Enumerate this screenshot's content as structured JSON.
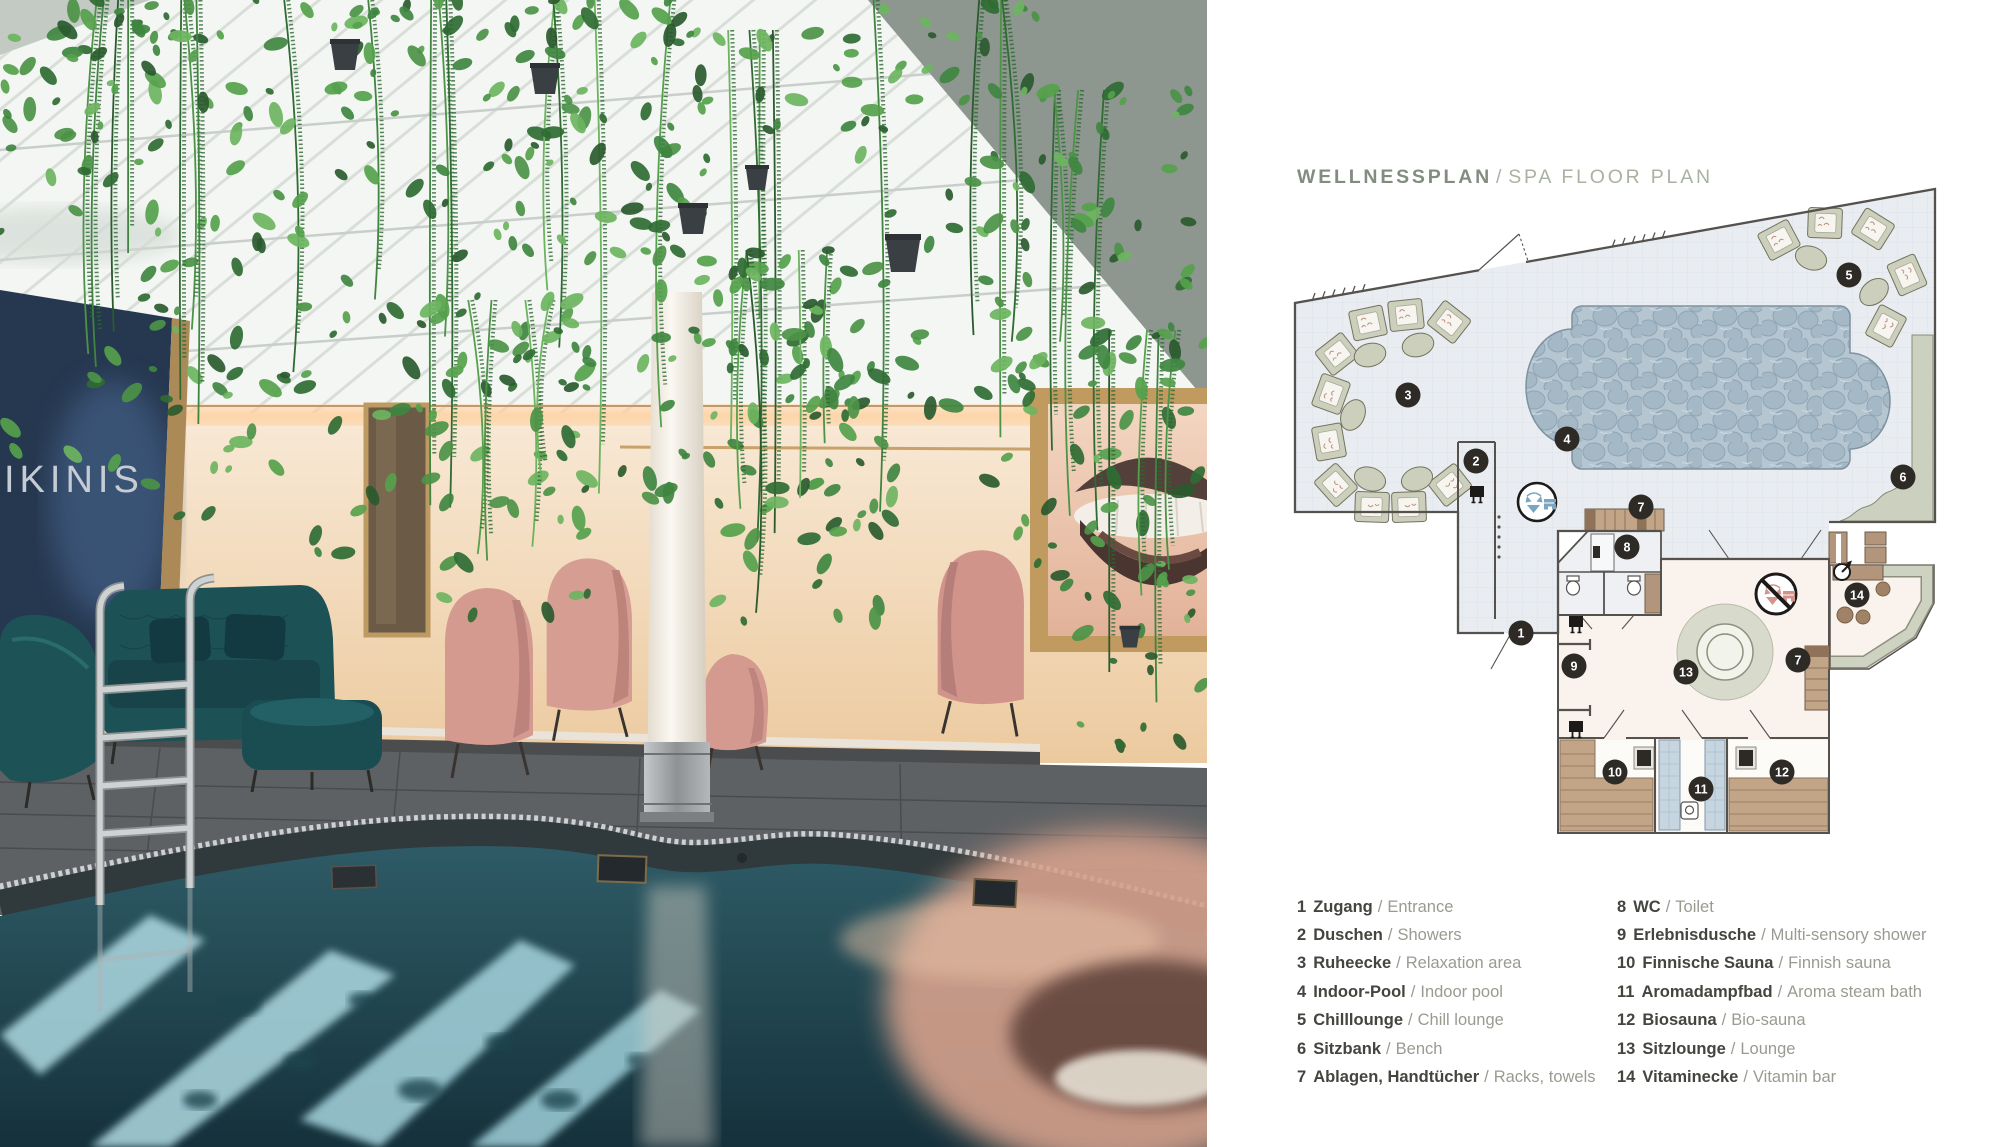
{
  "title": {
    "de": "WELLNESSPLAN",
    "separator": "/",
    "en": "SPA FLOOR PLAN"
  },
  "photo": {
    "wall_text": "IKINIS",
    "description": "indoor spa pool with hanging plants, pink lounge chairs, teal sofa, lips artwork",
    "plants": [
      {
        "x": 0,
        "y": 0,
        "w": 210,
        "h": 470
      },
      {
        "x": 150,
        "y": 0,
        "w": 200,
        "h": 560
      },
      {
        "x": 330,
        "y": 0,
        "w": 210,
        "h": 520
      },
      {
        "x": 520,
        "y": 0,
        "w": 190,
        "h": 500
      },
      {
        "x": 640,
        "y": 30,
        "w": 220,
        "h": 560
      },
      {
        "x": 830,
        "y": 0,
        "w": 210,
        "h": 540
      },
      {
        "x": 990,
        "y": 90,
        "w": 200,
        "h": 500
      },
      {
        "x": 1080,
        "y": 330,
        "w": 125,
        "h": 420
      },
      {
        "x": 430,
        "y": 300,
        "w": 160,
        "h": 330
      },
      {
        "x": 700,
        "y": 250,
        "w": 180,
        "h": 380
      }
    ]
  },
  "legend_left": [
    {
      "num": "1",
      "de": "Zugang",
      "en": "Entrance"
    },
    {
      "num": "2",
      "de": "Duschen",
      "en": "Showers"
    },
    {
      "num": "3",
      "de": "Ruheecke",
      "en": "Relaxation area"
    },
    {
      "num": "4",
      "de": "Indoor-Pool",
      "en": "Indoor pool"
    },
    {
      "num": "5",
      "de": "Chilllounge",
      "en": "Chill lounge"
    },
    {
      "num": "6",
      "de": "Sitzbank",
      "en": "Bench"
    },
    {
      "num": "7",
      "de": "Ablagen, Handtücher",
      "en": "Racks, towels"
    }
  ],
  "legend_right": [
    {
      "num": "8",
      "de": "WC",
      "en": "Toilet"
    },
    {
      "num": "9",
      "de": "Erlebnisdusche",
      "en": "Multi-sensory shower"
    },
    {
      "num": "10",
      "de": "Finnische Sauna",
      "en": "Finnish sauna"
    },
    {
      "num": "11",
      "de": "Aromadampfbad",
      "en": "Aroma steam bath"
    },
    {
      "num": "12",
      "de": "Biosauna",
      "en": "Bio-sauna"
    },
    {
      "num": "13",
      "de": "Sitzlounge",
      "en": "Lounge"
    },
    {
      "num": "14",
      "de": "Vitaminecke",
      "en": "Vitamin bar"
    }
  ],
  "plan": {
    "markers": [
      {
        "num": "1",
        "x": 239,
        "y": 451
      },
      {
        "num": "2",
        "x": 194,
        "y": 279
      },
      {
        "num": "3",
        "x": 126,
        "y": 213
      },
      {
        "num": "4",
        "x": 285,
        "y": 257
      },
      {
        "num": "5",
        "x": 567,
        "y": 93
      },
      {
        "num": "6",
        "x": 621,
        "y": 295
      },
      {
        "num": "7",
        "x": 359,
        "y": 325
      },
      {
        "num": "7",
        "x": 516,
        "y": 478
      },
      {
        "num": "8",
        "x": 345,
        "y": 365
      },
      {
        "num": "9",
        "x": 292,
        "y": 484
      },
      {
        "num": "10",
        "x": 333,
        "y": 590
      },
      {
        "num": "11",
        "x": 419,
        "y": 607
      },
      {
        "num": "12",
        "x": 500,
        "y": 590
      },
      {
        "num": "13",
        "x": 404,
        "y": 490
      },
      {
        "num": "14",
        "x": 575,
        "y": 413
      }
    ],
    "icons": [
      "swimwear-allowed-icon",
      "no-swimwear-icon",
      "shower-icon",
      "sauna-stove-icon",
      "water-tap-icon",
      "toilet-icon",
      "steam-seat-icon"
    ]
  },
  "colors": {
    "marker": "#2e2a26",
    "marker_text": "#ffffff",
    "hall_floor": "#e9edf2",
    "grid": "#dde2ea",
    "pool_base": "#b5c6d1",
    "pebble": "#a4b8c6",
    "sage": "#cbcfbb",
    "wing_floor": "#faf2ec",
    "wood": "#c2a486",
    "wood_dark": "#8f7257",
    "wall": "#55524e",
    "swimwear_blue": "#7ba6c2",
    "swimwear_pink": "#d4938a",
    "title_de": "#828d80",
    "title_en": "#a9b2a3",
    "legend_de": "#45443f",
    "legend_en": "#9b9a91"
  }
}
